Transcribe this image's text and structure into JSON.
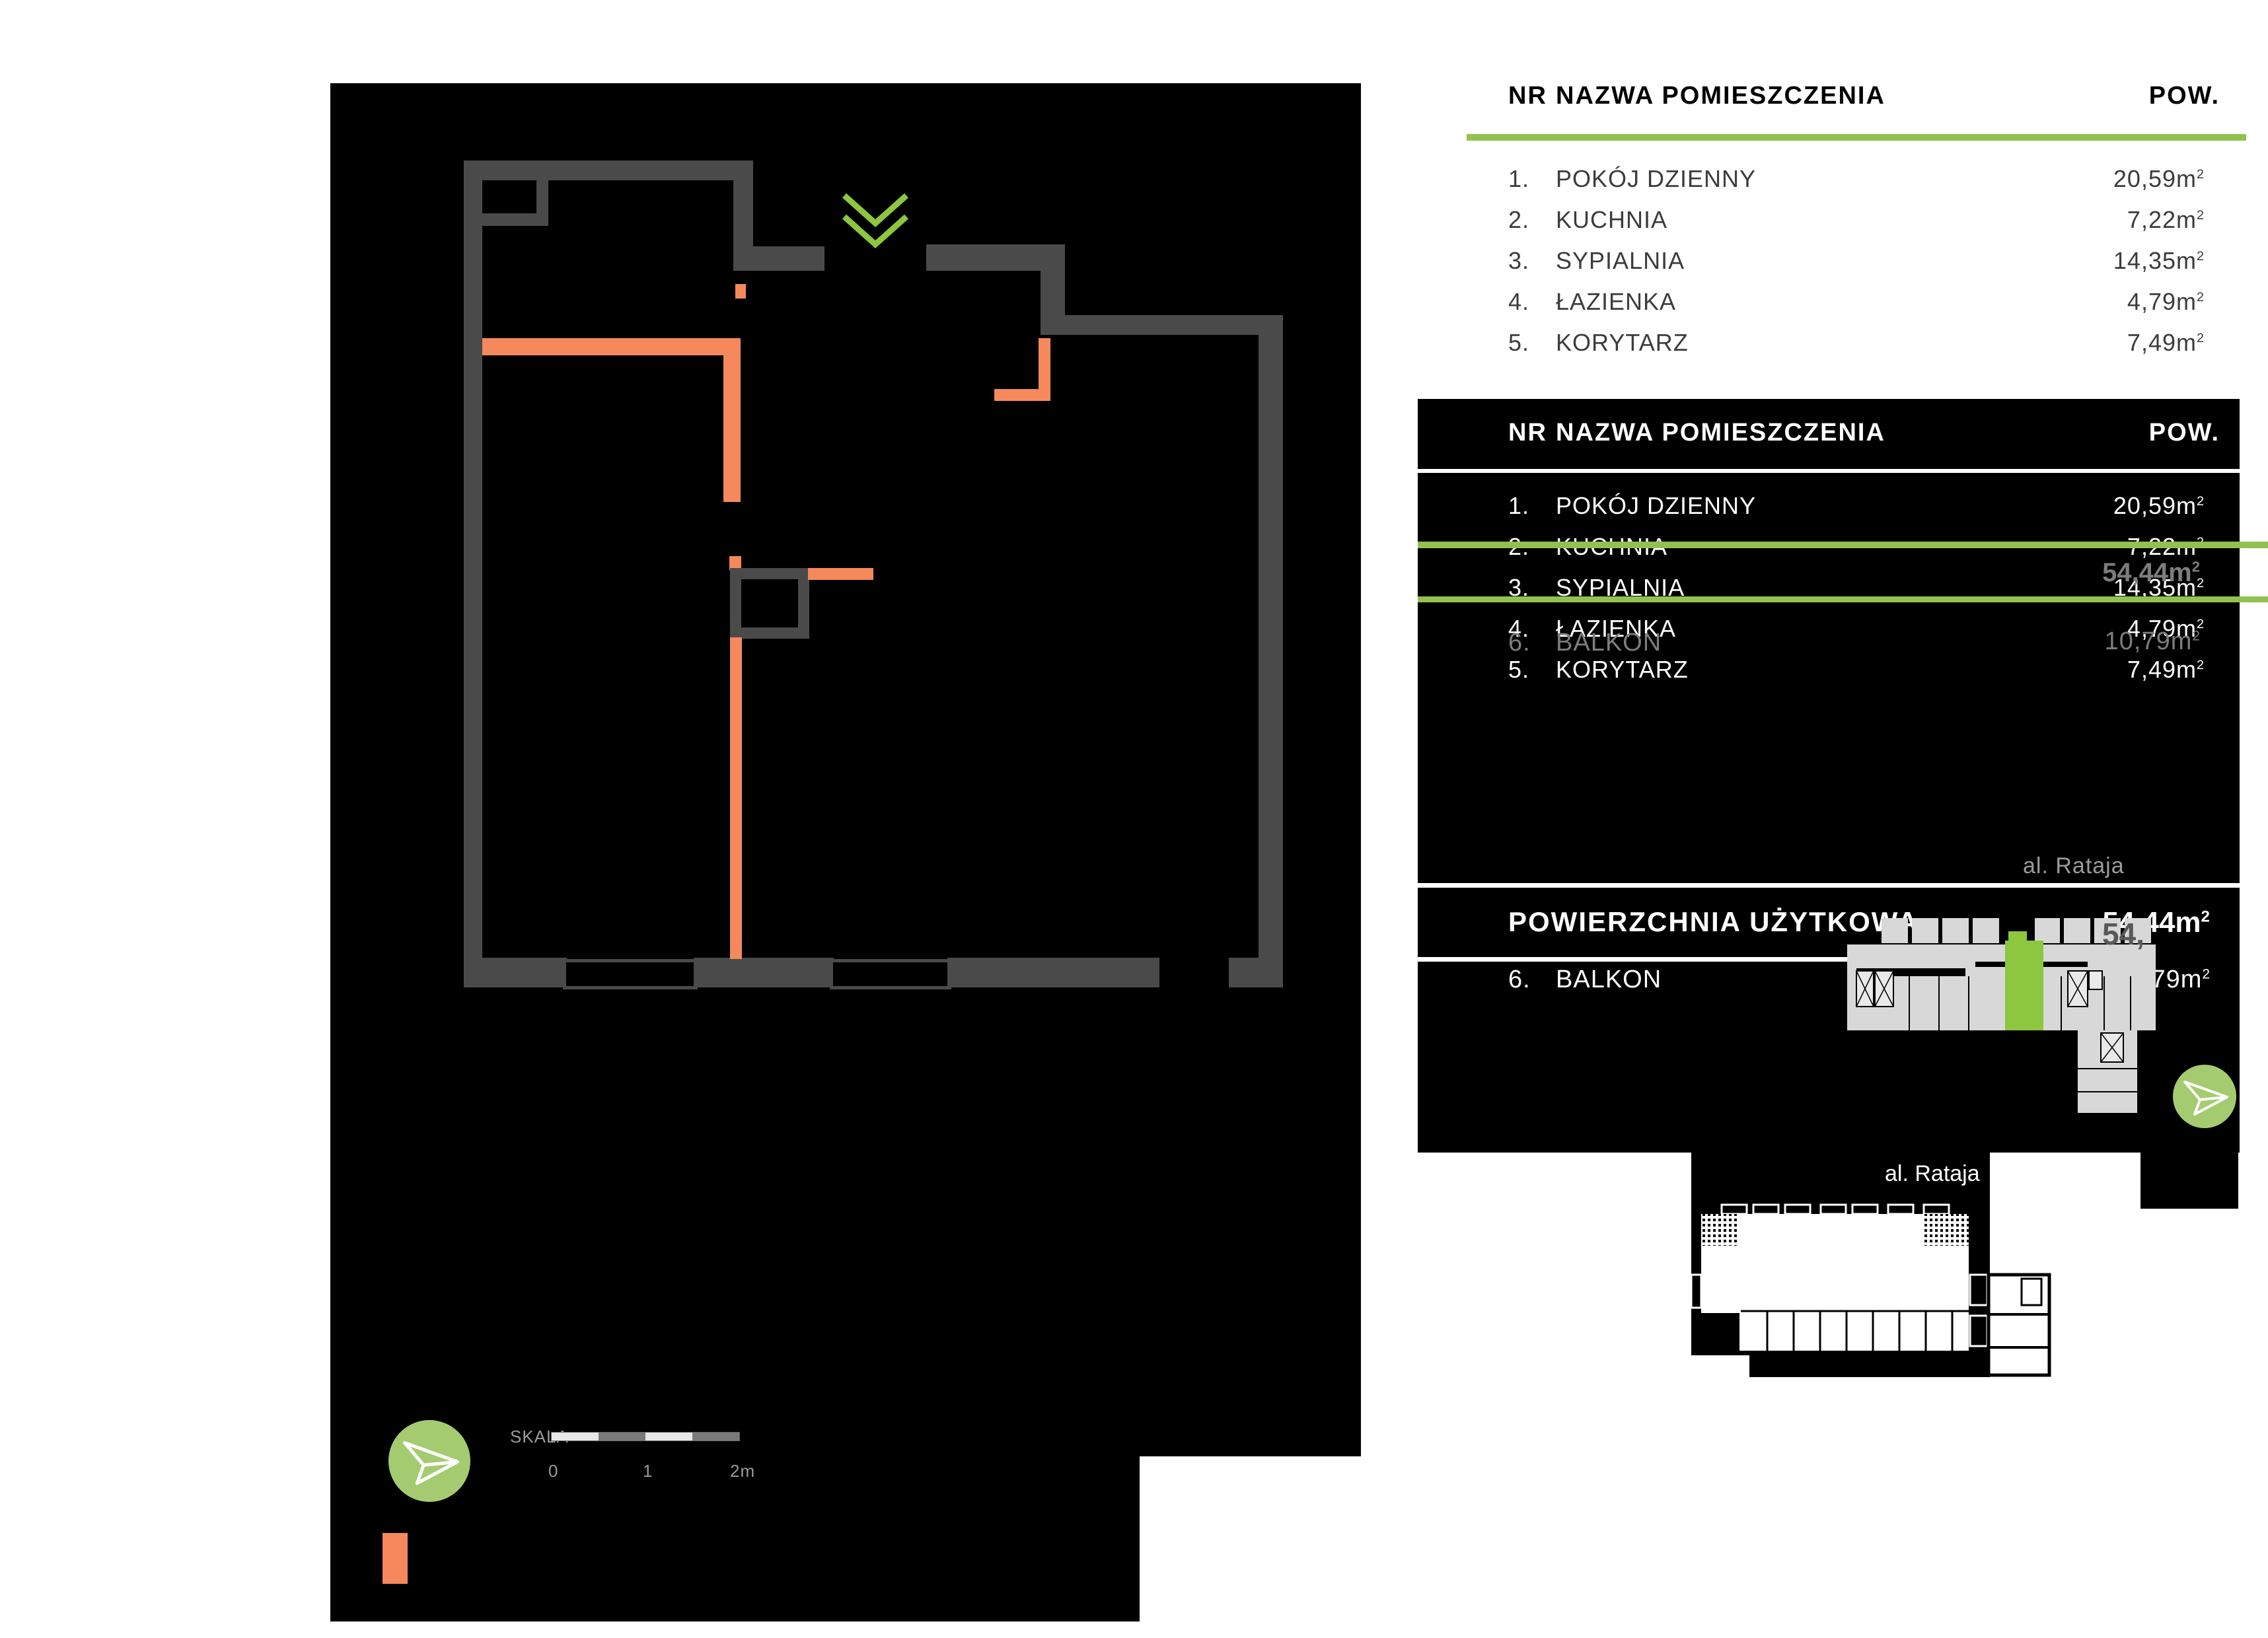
{
  "room_table": {
    "headers": {
      "nr": "NR",
      "name": "NAZWA POMIESZCZENIA",
      "area": "POW."
    },
    "sup": "2",
    "rooms": [
      {
        "num": "1.",
        "name": "POKÓJ DZIENNY",
        "area": "20,59m"
      },
      {
        "num": "2.",
        "name": "KUCHNIA",
        "area": "7,22m"
      },
      {
        "num": "3.",
        "name": "SYPIALNIA",
        "area": "14,35m"
      },
      {
        "num": "4.",
        "name": "ŁAZIENKA",
        "area": "4,79m"
      },
      {
        "num": "5.",
        "name": "KORYTARZ",
        "area": "7,49m"
      }
    ]
  },
  "summary": {
    "label": "POWIERZCHNIA UŻYTKOWA",
    "total_area": "54,44m",
    "ghost_total": "54,44m",
    "ghost_partial": "54,",
    "balkon_num": "6.",
    "balkon_name": "BALKON",
    "balkon_area": "10,79m",
    "ghost_balkon_num": "6.",
    "ghost_balkon_name": "BALKON",
    "ghost_balkon_area": "10,79m"
  },
  "street_label_top": "al. Rataja",
  "street_label_bottom": "al. Rataja",
  "scale": {
    "label": "SKALA",
    "tick0": "0",
    "tick1": "1",
    "tick2": "2m"
  },
  "colors": {
    "accent_green": "#8dc63f",
    "table_line_green": "#92c14f",
    "circle_green": "#a5cb70",
    "orange": "#f6895b",
    "wall_gray": "#4a4a4a",
    "building_gray": "#d8d8d8",
    "ghost_gray": "#7d7d7d"
  }
}
